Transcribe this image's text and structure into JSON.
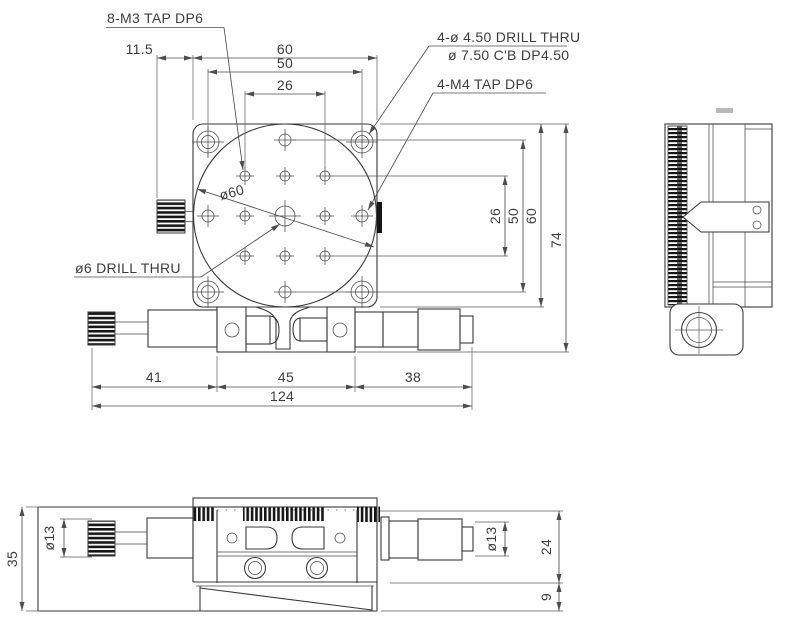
{
  "annotations": {
    "m3_tap": "8-M3 TAP DP6",
    "drill_thru_cb_1": "4-ø 4.50 DRILL THRU",
    "drill_thru_cb_2": "ø 7.50 C'B DP4.50",
    "m4_tap": "4-M4 TAP DP6",
    "center_drill": "ø6 DRILL THRU",
    "platform_dia": "ø60"
  },
  "dimensions": {
    "top_view": {
      "knob_offset": "11.5",
      "plate_width": "60",
      "hole_span_h50": "50",
      "hole_span_h26": "26",
      "hole_span_v26": "26",
      "hole_span_v50": "50",
      "plate_height": "60",
      "overall_height": "74",
      "seg_41": "41",
      "seg_45": "45",
      "seg_38": "38",
      "overall_length": "124"
    },
    "front_view": {
      "height_35": "35",
      "knob_dia_left": "ø13",
      "knob_dia_right": "ø13",
      "body_height_24": "24",
      "base_height_9": "9"
    }
  },
  "colors": {
    "line": "#3a3a3a",
    "text": "#3d3d3d",
    "knurl": "#161616",
    "background": "#ffffff"
  }
}
